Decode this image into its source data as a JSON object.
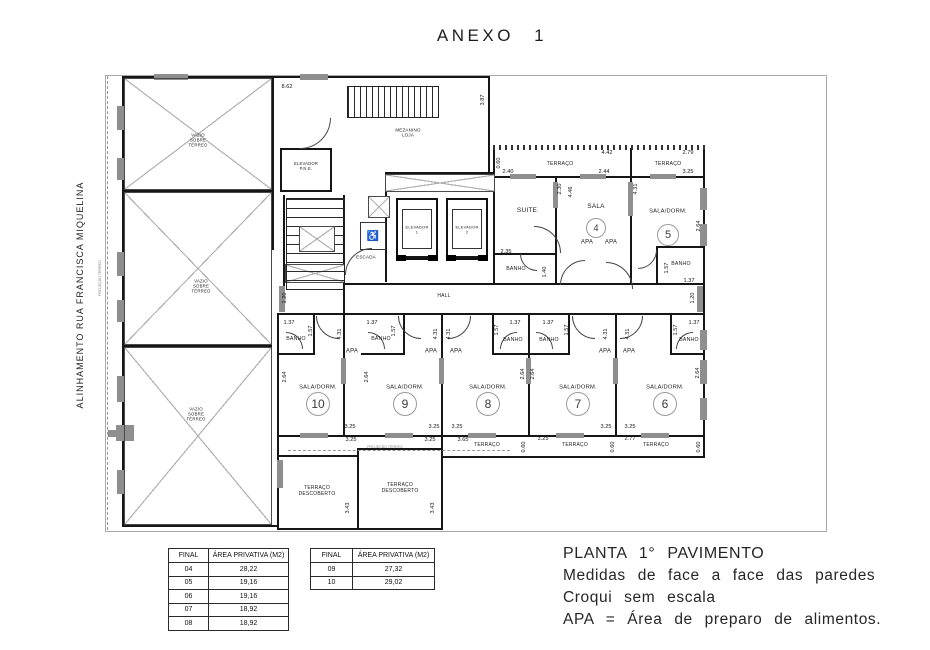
{
  "page": {
    "title": "ANEXO  1"
  },
  "side": {
    "alignment": "ALINHAMENTO  RUA  FRANCISCA  MIQUELINA",
    "projection": "PROJEÇÃO TÉRREO"
  },
  "legend": {
    "line1": "PLANTA  1°  PAVIMENTO",
    "line2": "Medidas  de  face  a  face  das  paredes",
    "line3": "Croqui  sem  escala",
    "line4": "APA  =  Área  de  preparo  de  alimentos."
  },
  "area_tables": [
    {
      "headers": [
        "FINAL",
        "ÁREA PRIVATIVA (M2)"
      ],
      "rows": [
        [
          "04",
          "28,22"
        ],
        [
          "05",
          "19,16"
        ],
        [
          "06",
          "19,16"
        ],
        [
          "07",
          "18,92"
        ],
        [
          "08",
          "18,92"
        ]
      ]
    },
    {
      "headers": [
        "FINAL",
        "ÁREA PRIVATIVA (M2)"
      ],
      "rows": [
        [
          "09",
          "27,32"
        ],
        [
          "10",
          "29,02"
        ]
      ]
    }
  ],
  "plan": {
    "projection_note": "PROJEÇÃO TÉRREO",
    "wheelchair_icon": "♿",
    "room_labels": [
      {
        "name": "room-label-vazio-1",
        "t": "VAZIO\nSOBRE\nTÉRREO",
        "x": 198,
        "y": 140,
        "fs": 4.3
      },
      {
        "name": "room-label-vazio-2",
        "t": "VAZIO\nSOBRE\nTÉRREO",
        "x": 201,
        "y": 286,
        "fs": 4.3
      },
      {
        "name": "room-label-vazio-3",
        "t": "VAZIO\nSOBRE\nTÉRREO",
        "x": 196,
        "y": 414,
        "fs": 4.3
      },
      {
        "name": "room-label-mezanino-loja",
        "t": "MEZANINO\nLOJA",
        "x": 408,
        "y": 133,
        "fs": 4.5
      },
      {
        "name": "room-label-elevador-pne",
        "t": "ELEVADOR\nP.N.E.",
        "x": 306,
        "y": 167,
        "fs": 4.2
      },
      {
        "name": "room-label-elevador-1",
        "t": "ELEVADOR\n1",
        "x": 417,
        "y": 230,
        "fs": 4
      },
      {
        "name": "room-label-elevador-2",
        "t": "ELEVADOR\n2",
        "x": 467,
        "y": 230,
        "fs": 4
      },
      {
        "name": "room-label-escada",
        "t": "ESCADA",
        "x": 366,
        "y": 257,
        "fs": 4.5
      },
      {
        "name": "room-label-hall",
        "t": "HALL",
        "x": 444,
        "y": 297,
        "fs": 5
      },
      {
        "name": "room-label-suite",
        "t": "SUITE",
        "x": 527,
        "y": 211,
        "fs": 6.5
      },
      {
        "name": "room-label-sala-4",
        "t": "SALA",
        "x": 596,
        "y": 207,
        "fs": 6.5
      },
      {
        "name": "room-label-sala-dorm-5",
        "t": "SALA/DORM.",
        "x": 668,
        "y": 212,
        "fs": 5.8
      },
      {
        "name": "room-label-apa",
        "t": "APA",
        "x": 587,
        "y": 243,
        "fs": 6
      },
      {
        "name": "room-label-apa",
        "t": "APA",
        "x": 611,
        "y": 243,
        "fs": 6
      },
      {
        "name": "room-label-banho-suite",
        "t": "BANHO",
        "x": 516,
        "y": 269,
        "fs": 5.2
      },
      {
        "name": "room-label-banho-5",
        "t": "BANHO",
        "x": 681,
        "y": 264,
        "fs": 5.2
      },
      {
        "name": "room-label-terraco-4",
        "t": "TERRAÇO",
        "x": 560,
        "y": 164,
        "fs": 5.2
      },
      {
        "name": "room-label-terraco-5",
        "t": "TERRAÇO",
        "x": 668,
        "y": 164,
        "fs": 5.2
      },
      {
        "name": "room-label-banho-10",
        "t": "BANHO",
        "x": 296,
        "y": 339,
        "fs": 5.2
      },
      {
        "name": "room-label-banho-9",
        "t": "BANHO",
        "x": 381,
        "y": 339,
        "fs": 5.2
      },
      {
        "name": "room-label-banho-8",
        "t": "BANHO",
        "x": 513,
        "y": 340,
        "fs": 5.2
      },
      {
        "name": "room-label-banho-7",
        "t": "BANHO",
        "x": 549,
        "y": 340,
        "fs": 5.2
      },
      {
        "name": "room-label-banho-6",
        "t": "BANHO",
        "x": 689,
        "y": 340,
        "fs": 5.2
      },
      {
        "name": "room-label-apa",
        "t": "APA",
        "x": 352,
        "y": 352,
        "fs": 6
      },
      {
        "name": "room-label-apa",
        "t": "APA",
        "x": 431,
        "y": 352,
        "fs": 6
      },
      {
        "name": "room-label-apa",
        "t": "APA",
        "x": 456,
        "y": 352,
        "fs": 6
      },
      {
        "name": "room-label-apa",
        "t": "APA",
        "x": 605,
        "y": 352,
        "fs": 6
      },
      {
        "name": "room-label-apa",
        "t": "APA",
        "x": 629,
        "y": 352,
        "fs": 6
      },
      {
        "name": "room-label-sala-dorm-10",
        "t": "SALA/DORM.",
        "x": 318,
        "y": 388,
        "fs": 5.8
      },
      {
        "name": "room-label-sala-dorm-9",
        "t": "SALA/DORM.",
        "x": 405,
        "y": 388,
        "fs": 5.8
      },
      {
        "name": "room-label-sala-dorm-8",
        "t": "SALA/DORM.",
        "x": 488,
        "y": 388,
        "fs": 5.8
      },
      {
        "name": "room-label-sala-dorm-7",
        "t": "SALA/DORM.",
        "x": 578,
        "y": 388,
        "fs": 5.8
      },
      {
        "name": "room-label-sala-dorm-6",
        "t": "SALA/DORM.",
        "x": 665,
        "y": 388,
        "fs": 5.8
      },
      {
        "name": "room-label-terraco-8",
        "t": "TERRAÇO",
        "x": 487,
        "y": 446,
        "fs": 5
      },
      {
        "name": "room-label-terraco-7",
        "t": "TERRAÇO",
        "x": 575,
        "y": 446,
        "fs": 5
      },
      {
        "name": "room-label-terraco-6",
        "t": "TERRAÇO",
        "x": 656,
        "y": 446,
        "fs": 5
      },
      {
        "name": "room-label-terraco-descoberto-10",
        "t": "TERRAÇO\nDESCOBERTO",
        "x": 317,
        "y": 492,
        "fs": 5
      },
      {
        "name": "room-label-terraco-descoberto-9",
        "t": "TERRAÇO\nDESCOBERTO",
        "x": 400,
        "y": 489,
        "fs": 5
      }
    ],
    "unit_circles": [
      {
        "n": "4",
        "x": 596,
        "y": 228,
        "r": 9
      },
      {
        "n": "5",
        "x": 668,
        "y": 235,
        "r": 10
      },
      {
        "n": "10",
        "x": 318,
        "y": 404,
        "r": 11
      },
      {
        "n": "9",
        "x": 405,
        "y": 404,
        "r": 11
      },
      {
        "n": "8",
        "x": 488,
        "y": 404,
        "r": 11
      },
      {
        "n": "7",
        "x": 578,
        "y": 404,
        "r": 11
      },
      {
        "n": "6",
        "x": 665,
        "y": 404,
        "r": 11
      }
    ],
    "dim_labels": [
      {
        "t": "8.62",
        "x": 287,
        "y": 87
      },
      {
        "t": "3.87",
        "x": 483,
        "y": 100,
        "v": 1
      },
      {
        "t": "0.60",
        "x": 499,
        "y": 163,
        "v": 1
      },
      {
        "t": "4.42",
        "x": 607,
        "y": 153
      },
      {
        "t": "2.79",
        "x": 688,
        "y": 153
      },
      {
        "t": "2.40",
        "x": 508,
        "y": 172
      },
      {
        "t": "2.30",
        "x": 560,
        "y": 189,
        "v": 1
      },
      {
        "t": "4.46",
        "x": 571,
        "y": 192,
        "v": 1
      },
      {
        "t": "2.44",
        "x": 604,
        "y": 172
      },
      {
        "t": "4.31",
        "x": 636,
        "y": 189,
        "v": 1
      },
      {
        "t": "3.25",
        "x": 688,
        "y": 172
      },
      {
        "t": "2.64",
        "x": 699,
        "y": 226,
        "v": 1
      },
      {
        "t": "2.35",
        "x": 506,
        "y": 252
      },
      {
        "t": "1.40",
        "x": 545,
        "y": 272,
        "v": 1
      },
      {
        "t": "1.57",
        "x": 667,
        "y": 268,
        "v": 1
      },
      {
        "t": "1.37",
        "x": 689,
        "y": 281
      },
      {
        "t": "1.20",
        "x": 285,
        "y": 298,
        "v": 1
      },
      {
        "t": "1.20",
        "x": 693,
        "y": 298,
        "v": 1
      },
      {
        "t": "1.37",
        "x": 289,
        "y": 323
      },
      {
        "t": "1.57",
        "x": 311,
        "y": 331,
        "v": 1
      },
      {
        "t": "4.31",
        "x": 340,
        "y": 334,
        "v": 1
      },
      {
        "t": "1.37",
        "x": 372,
        "y": 323
      },
      {
        "t": "1.57",
        "x": 394,
        "y": 331,
        "v": 1
      },
      {
        "t": "4.31",
        "x": 436,
        "y": 334,
        "v": 1
      },
      {
        "t": "4.31",
        "x": 449,
        "y": 334,
        "v": 1
      },
      {
        "t": "1.57",
        "x": 497,
        "y": 330,
        "v": 1
      },
      {
        "t": "1.37",
        "x": 515,
        "y": 323
      },
      {
        "t": "1.37",
        "x": 548,
        "y": 323
      },
      {
        "t": "1.57",
        "x": 567,
        "y": 330,
        "v": 1
      },
      {
        "t": "4.31",
        "x": 606,
        "y": 334,
        "v": 1
      },
      {
        "t": "4.31",
        "x": 628,
        "y": 334,
        "v": 1
      },
      {
        "t": "1.57",
        "x": 676,
        "y": 330,
        "v": 1
      },
      {
        "t": "1.37",
        "x": 694,
        "y": 323
      },
      {
        "t": "2.64",
        "x": 285,
        "y": 377,
        "v": 1
      },
      {
        "t": "2.64",
        "x": 367,
        "y": 377,
        "v": 1
      },
      {
        "t": "2.64",
        "x": 523,
        "y": 374,
        "v": 1
      },
      {
        "t": "2.64",
        "x": 533,
        "y": 374,
        "v": 1
      },
      {
        "t": "2.64",
        "x": 698,
        "y": 373,
        "v": 1
      },
      {
        "t": "3.25",
        "x": 350,
        "y": 427
      },
      {
        "t": "3.25",
        "x": 434,
        "y": 427
      },
      {
        "t": "3.25",
        "x": 457,
        "y": 427
      },
      {
        "t": "3.25",
        "x": 606,
        "y": 427
      },
      {
        "t": "3.25",
        "x": 630,
        "y": 427
      },
      {
        "t": "3.25",
        "x": 351,
        "y": 440
      },
      {
        "t": "3.25",
        "x": 430,
        "y": 440
      },
      {
        "t": "3.65",
        "x": 463,
        "y": 440
      },
      {
        "t": "3.25",
        "x": 543,
        "y": 439
      },
      {
        "t": "2.77",
        "x": 630,
        "y": 439
      },
      {
        "t": "0.60",
        "x": 524,
        "y": 447,
        "v": 1
      },
      {
        "t": "0.60",
        "x": 613,
        "y": 447,
        "v": 1
      },
      {
        "t": "0.60",
        "x": 699,
        "y": 447,
        "v": 1
      },
      {
        "t": "3.43",
        "x": 348,
        "y": 508,
        "v": 1
      },
      {
        "t": "3.43",
        "x": 433,
        "y": 508,
        "v": 1
      }
    ]
  }
}
